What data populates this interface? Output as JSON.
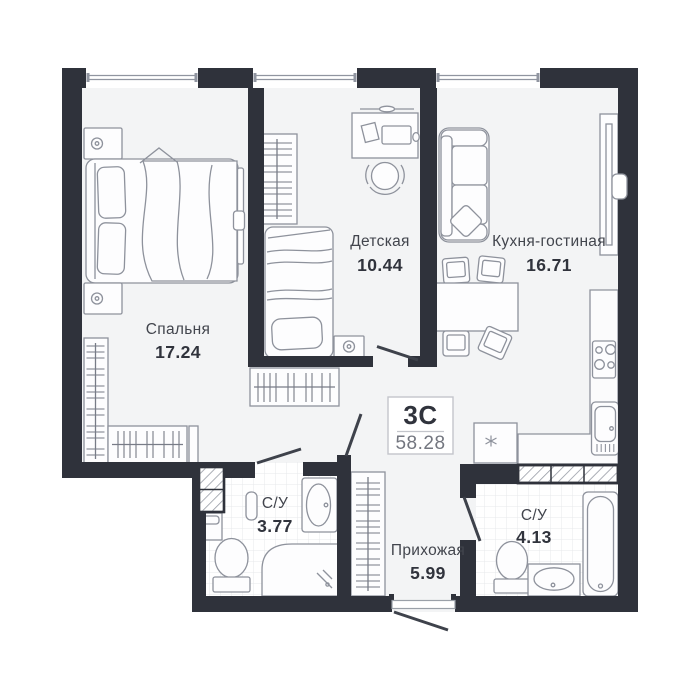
{
  "plan": {
    "unit": {
      "type_label": "3С",
      "total_area": "58.28"
    },
    "rooms": [
      {
        "name": "Спальня",
        "area": "17.24"
      },
      {
        "name": "Детская",
        "area": "10.44"
      },
      {
        "name": "Кухня-гостиная",
        "area": "16.71"
      },
      {
        "name": "С/У",
        "area": "3.77"
      },
      {
        "name": "Прихожая",
        "area": "5.99"
      },
      {
        "name": "С/У",
        "area": "4.13"
      }
    ],
    "colors": {
      "wall": "#2f323b",
      "floor": "#f3f4f5",
      "furniture_line": "#8e929c",
      "text": "#42454d",
      "tile_line": "#e7e8eb"
    }
  }
}
